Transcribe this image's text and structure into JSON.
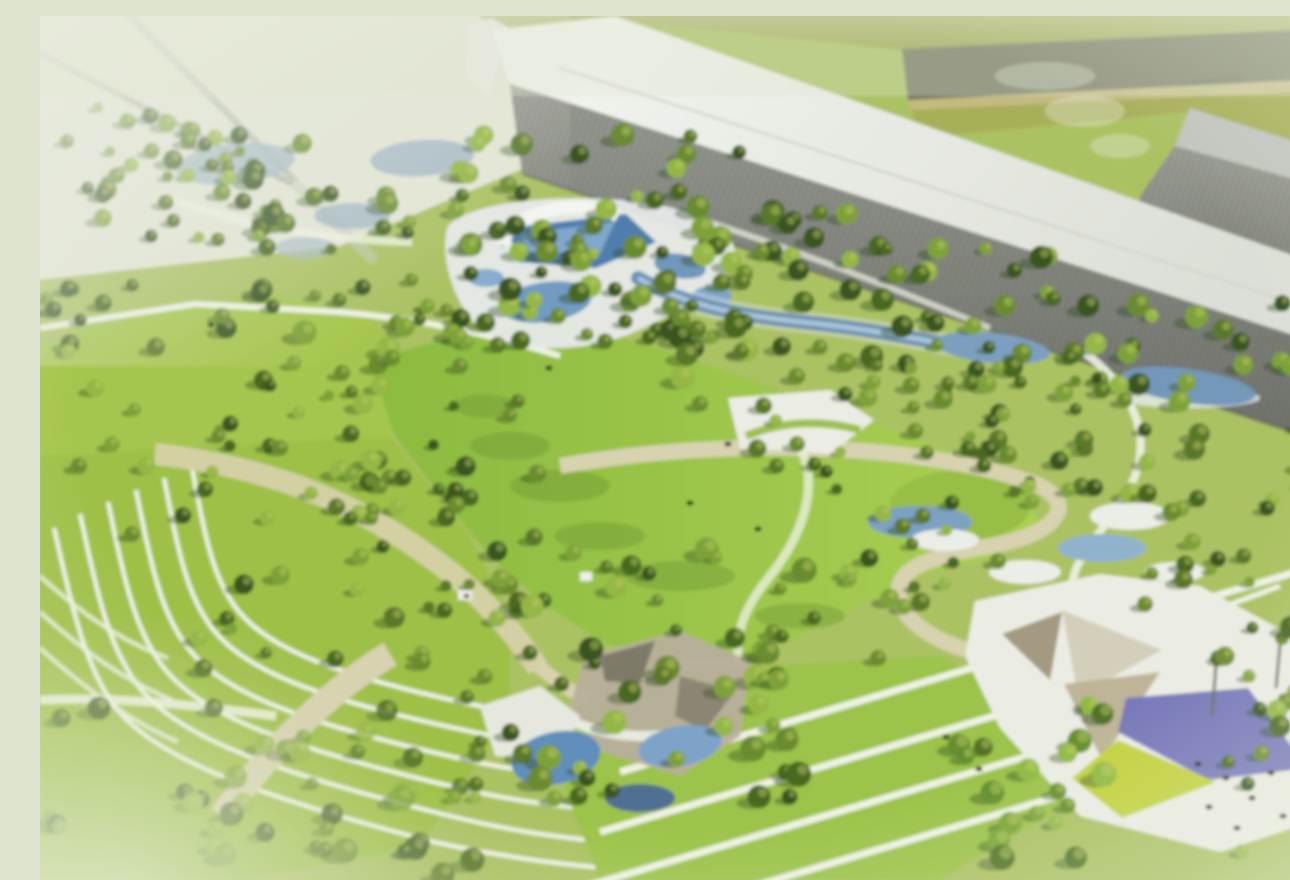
{
  "image": {
    "title": "Aerial rendering of landscaped park with water garden, terraced lawns, event plaza and industrial buildings",
    "type": "architectural-rendering"
  },
  "palette": {
    "haze": "#e4e8d6",
    "base_ground": "#abc35e",
    "field": "#a8b05a",
    "road": "#71755d",
    "road_line": "#c4bb7e",
    "meadow_left": "#a5c848",
    "terrace_ground": "#9fc243",
    "stripe_lawn": "#9cc544",
    "path_white": "#f0f4e4",
    "path_beige": "#d9d3ae",
    "terrace_line": "#eef3e2",
    "plaza": "#edefe5",
    "plaza_taupe": "#b9b09c",
    "plaza_dark": "#7e7a68",
    "canopy_taupe": "#a49a80",
    "canopy_light": "#d6d0ba",
    "canopy_tan": "#bfb596",
    "purple_sail": "#7678bd",
    "yellow_sail": "#c3d437",
    "water": "#6b92b4",
    "water_deep": "#4d7eb0",
    "water_mid": "#7ba0c2",
    "water_light": "#7fa9cd",
    "water_pale": "#a3b8c6",
    "deck_white": "#e9edef",
    "people": "#23231f",
    "trunk": "#6b6f5e",
    "shadow_green": "#2c461b",
    "hut_white": "#f0f2ea",
    "hut_dark": "#3a3f34"
  },
  "scene": {
    "tree_palette": [
      "#37541f",
      "#47671f",
      "#587826",
      "#698c2c",
      "#7da334",
      "#93b83f"
    ],
    "leafy_palette": [
      "#4f7323",
      "#639029",
      "#78a732",
      "#8fbc3e"
    ],
    "highlight": "#c4d063",
    "tree_clusters": [
      {
        "name": "far-topleft",
        "x": 0,
        "y": 88,
        "w": 150,
        "h": 135,
        "count": 16,
        "seed": 11,
        "rmin": 5,
        "rmax": 10
      },
      {
        "name": "north-left",
        "x": 120,
        "y": 112,
        "w": 190,
        "h": 125,
        "count": 24,
        "seed": 12,
        "rmin": 5,
        "rmax": 10
      },
      {
        "name": "pool-band",
        "x": 175,
        "y": 150,
        "w": 340,
        "h": 185,
        "count": 46,
        "seed": 13,
        "rmin": 6,
        "rmax": 12
      },
      {
        "name": "north-central",
        "x": 415,
        "y": 118,
        "w": 310,
        "h": 215,
        "count": 55,
        "seed": 14,
        "rmin": 6,
        "rmax": 12
      },
      {
        "name": "building-front",
        "x": 600,
        "y": 195,
        "w": 430,
        "h": 175,
        "count": 62,
        "seed": 15,
        "rmin": 6,
        "rmax": 12
      },
      {
        "name": "east-forest",
        "x": 1000,
        "y": 285,
        "w": 290,
        "h": 200,
        "count": 40,
        "seed": 16,
        "rmin": 6,
        "rmax": 12
      },
      {
        "name": "east-lower",
        "x": 1095,
        "y": 470,
        "w": 195,
        "h": 115,
        "count": 15,
        "seed": 17,
        "rmin": 5,
        "rmax": 10
      },
      {
        "name": "mid-left",
        "x": 150,
        "y": 330,
        "w": 200,
        "h": 165,
        "count": 18,
        "seed": 18,
        "rmin": 5,
        "rmax": 10
      },
      {
        "name": "center-wood",
        "x": 300,
        "y": 385,
        "w": 200,
        "h": 225,
        "count": 28,
        "seed": 19,
        "rmin": 5,
        "rmax": 11
      },
      {
        "name": "south-forest",
        "x": 420,
        "y": 520,
        "w": 365,
        "h": 265,
        "count": 60,
        "seed": 20,
        "rmin": 6,
        "rmax": 13
      },
      {
        "name": "south-knoll",
        "x": 790,
        "y": 470,
        "w": 190,
        "h": 130,
        "count": 16,
        "seed": 21,
        "rmin": 5,
        "rmax": 10
      },
      {
        "name": "right-mid",
        "x": 930,
        "y": 360,
        "w": 170,
        "h": 140,
        "count": 18,
        "seed": 22,
        "rmin": 5,
        "rmax": 10
      },
      {
        "name": "terrace-scatter",
        "x": 140,
        "y": 460,
        "w": 270,
        "h": 195,
        "count": 22,
        "seed": 23,
        "rmin": 5,
        "rmax": 10
      },
      {
        "name": "stream-band",
        "x": 700,
        "y": 335,
        "w": 260,
        "h": 125,
        "count": 24,
        "seed": 24,
        "rmin": 5,
        "rmax": 10
      },
      {
        "name": "west-edge",
        "x": 0,
        "y": 250,
        "w": 120,
        "h": 215,
        "count": 16,
        "seed": 25,
        "rmin": 5,
        "rmax": 10
      },
      {
        "name": "southwest-mist",
        "x": 0,
        "y": 690,
        "w": 440,
        "h": 170,
        "count": 42,
        "seed": 26,
        "rmin": 6,
        "rmax": 13,
        "opacity": 0.8
      },
      {
        "name": "southeast-corner",
        "x": 1160,
        "y": 605,
        "w": 130,
        "h": 255,
        "count": 15,
        "seed": 27,
        "rmin": 6,
        "rmax": 12
      },
      {
        "name": "plaza-overhang",
        "x": 895,
        "y": 680,
        "w": 175,
        "h": 180,
        "count": 20,
        "seed": 28,
        "rmin": 7,
        "rmax": 13,
        "leafy": true
      }
    ],
    "single_trees": [
      [
        352,
        342
      ],
      [
        518,
        300
      ],
      [
        660,
        388
      ],
      [
        757,
        428
      ],
      [
        302,
        357
      ],
      [
        182,
        300
      ],
      [
        92,
        518
      ],
      [
        640,
        302
      ],
      [
        875,
        415
      ],
      [
        958,
        545
      ],
      [
        838,
        642
      ],
      [
        240,
        432
      ],
      [
        1105,
        588
      ],
      [
        420,
        350
      ]
    ],
    "people": [
      [
        1158,
        748
      ],
      [
        1186,
        762
      ],
      [
        1212,
        782
      ],
      [
        1243,
        800
      ],
      [
        1263,
        818
      ],
      [
        1197,
        812
      ],
      [
        1169,
        791
      ],
      [
        1231,
        757
      ],
      [
        906,
        721
      ],
      [
        939,
        753
      ],
      [
        650,
        487
      ],
      [
        718,
        513
      ],
      [
        509,
        352
      ],
      [
        688,
        428
      ],
      [
        171,
        309
      ]
    ]
  }
}
